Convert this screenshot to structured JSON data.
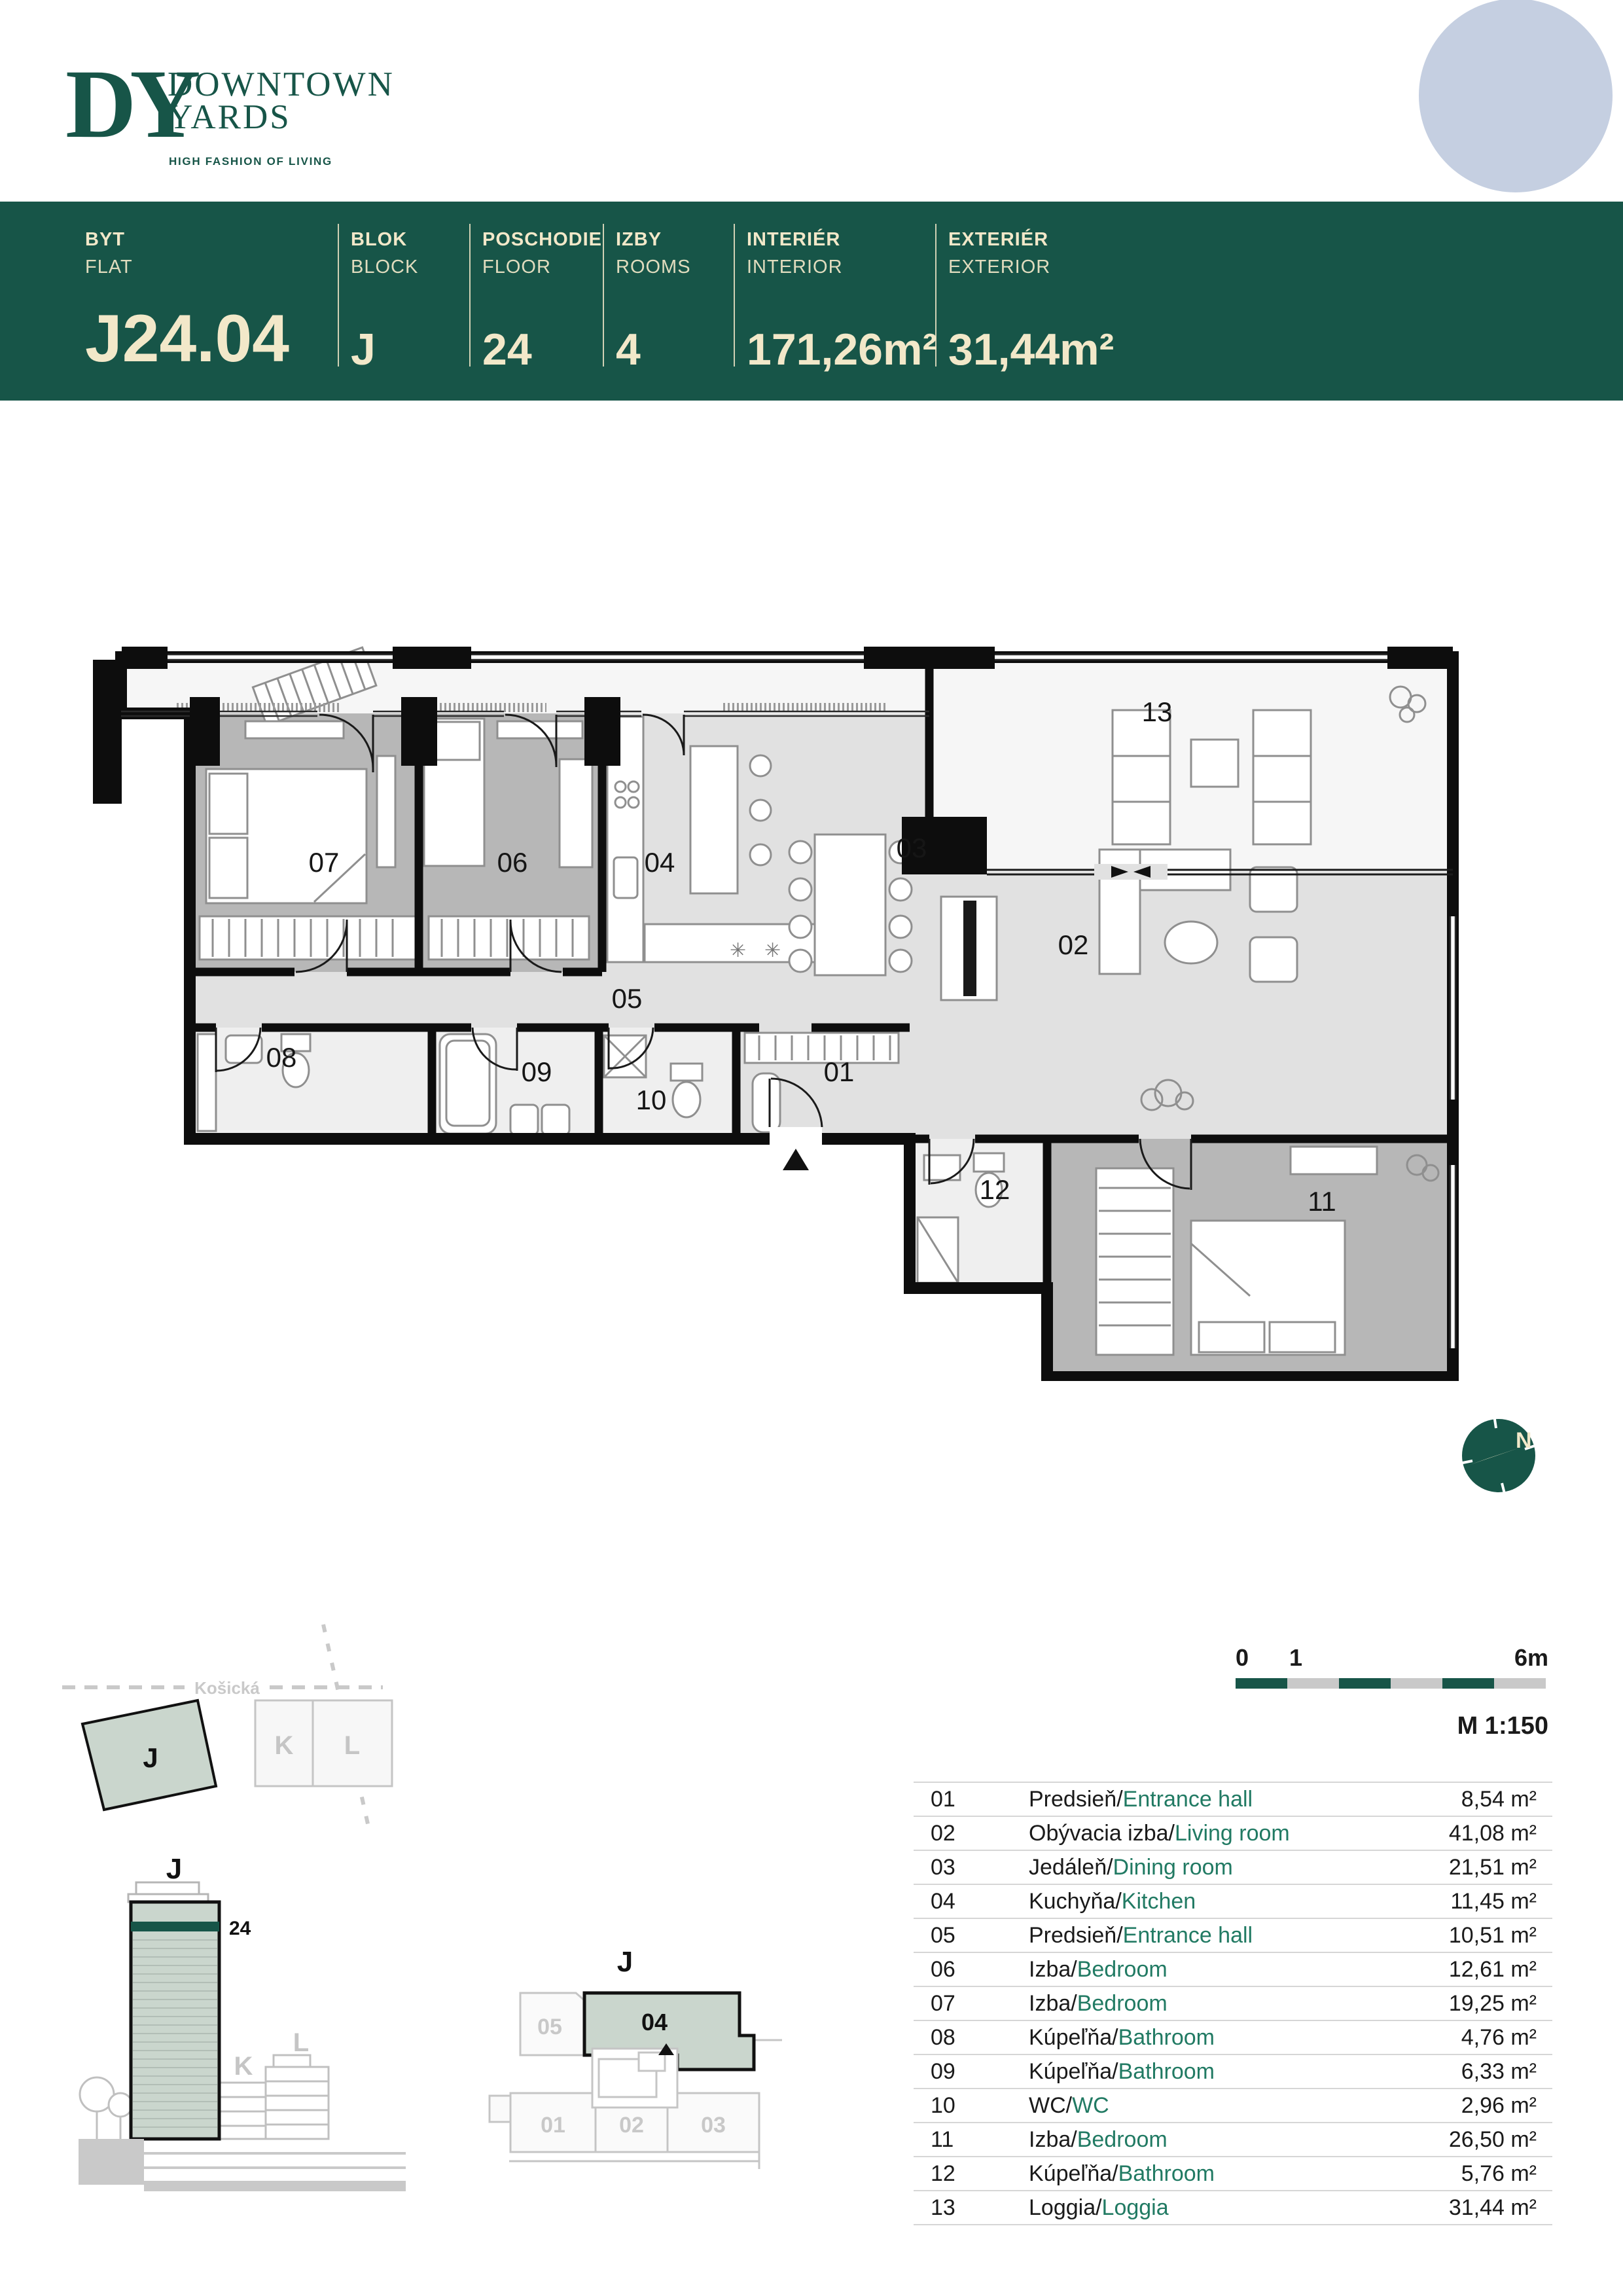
{
  "brand": {
    "initials": "DY",
    "name_line1": "DOWNTOWN",
    "name_line2": "YARDS",
    "tagline": "HIGH FASHION OF LIVING"
  },
  "banner": {
    "columns": [
      {
        "sk": "BYT",
        "en": "FLAT",
        "value": "J24.04"
      },
      {
        "sk": "BLOK",
        "en": "BLOCK",
        "value": "J"
      },
      {
        "sk": "POSCHODIE",
        "en": "FLOOR",
        "value": "24"
      },
      {
        "sk": "IZBY",
        "en": "ROOMS",
        "value": "4"
      },
      {
        "sk": "INTERIÉR",
        "en": "INTERIOR",
        "value": "171,26m²"
      },
      {
        "sk": "EXTERIÉR",
        "en": "EXTERIOR",
        "value": "31,44m²"
      }
    ]
  },
  "rooms": [
    {
      "num": "01",
      "sk": "Predsieň",
      "en": "Entrance hall",
      "area": "8,54 m²"
    },
    {
      "num": "02",
      "sk": "Obývacia izba",
      "en": "Living room",
      "area": "41,08 m²"
    },
    {
      "num": "03",
      "sk": "Jedáleň",
      "en": "Dining room",
      "area": "21,51 m²"
    },
    {
      "num": "04",
      "sk": "Kuchyňa",
      "en": "Kitchen",
      "area": "11,45 m²"
    },
    {
      "num": "05",
      "sk": "Predsieň",
      "en": "Entrance hall",
      "area": "10,51 m²"
    },
    {
      "num": "06",
      "sk": "Izba",
      "en": "Bedroom",
      "area": "12,61 m²"
    },
    {
      "num": "07",
      "sk": "Izba",
      "en": "Bedroom",
      "area": "19,25 m²"
    },
    {
      "num": "08",
      "sk": "Kúpeľňa",
      "en": "Bathroom",
      "area": "4,76 m²"
    },
    {
      "num": "09",
      "sk": "Kúpeľňa",
      "en": "Bathroom",
      "area": "6,33 m²"
    },
    {
      "num": "10",
      "sk": "WC",
      "en": "WC",
      "area": "2,96 m²"
    },
    {
      "num": "11",
      "sk": "Izba",
      "en": "Bedroom",
      "area": "26,50 m²"
    },
    {
      "num": "12",
      "sk": "Kúpeľňa",
      "en": "Bathroom",
      "area": "5,76 m²"
    },
    {
      "num": "13",
      "sk": "Loggia",
      "en": "Loggia",
      "area": "31,44 m²"
    }
  ],
  "compass": {
    "north": "N"
  },
  "scale": {
    "start": "0",
    "one": "1",
    "end": "6m",
    "ratio": "M 1:150"
  },
  "site": {
    "street": "Košická",
    "blocks": [
      "J",
      "K",
      "L"
    ]
  },
  "elevation": {
    "block": "J",
    "floor": "24",
    "neighbors": [
      "K",
      "L"
    ]
  },
  "keyplan": {
    "block": "J",
    "units": [
      "05",
      "04",
      "01",
      "02",
      "03"
    ]
  },
  "colors": {
    "brand_green": "#175548",
    "cream": "#F2E8C9",
    "table_green": "#217A63",
    "sage": "#CAD6CD",
    "circle_blue": "#C5CFE1"
  }
}
